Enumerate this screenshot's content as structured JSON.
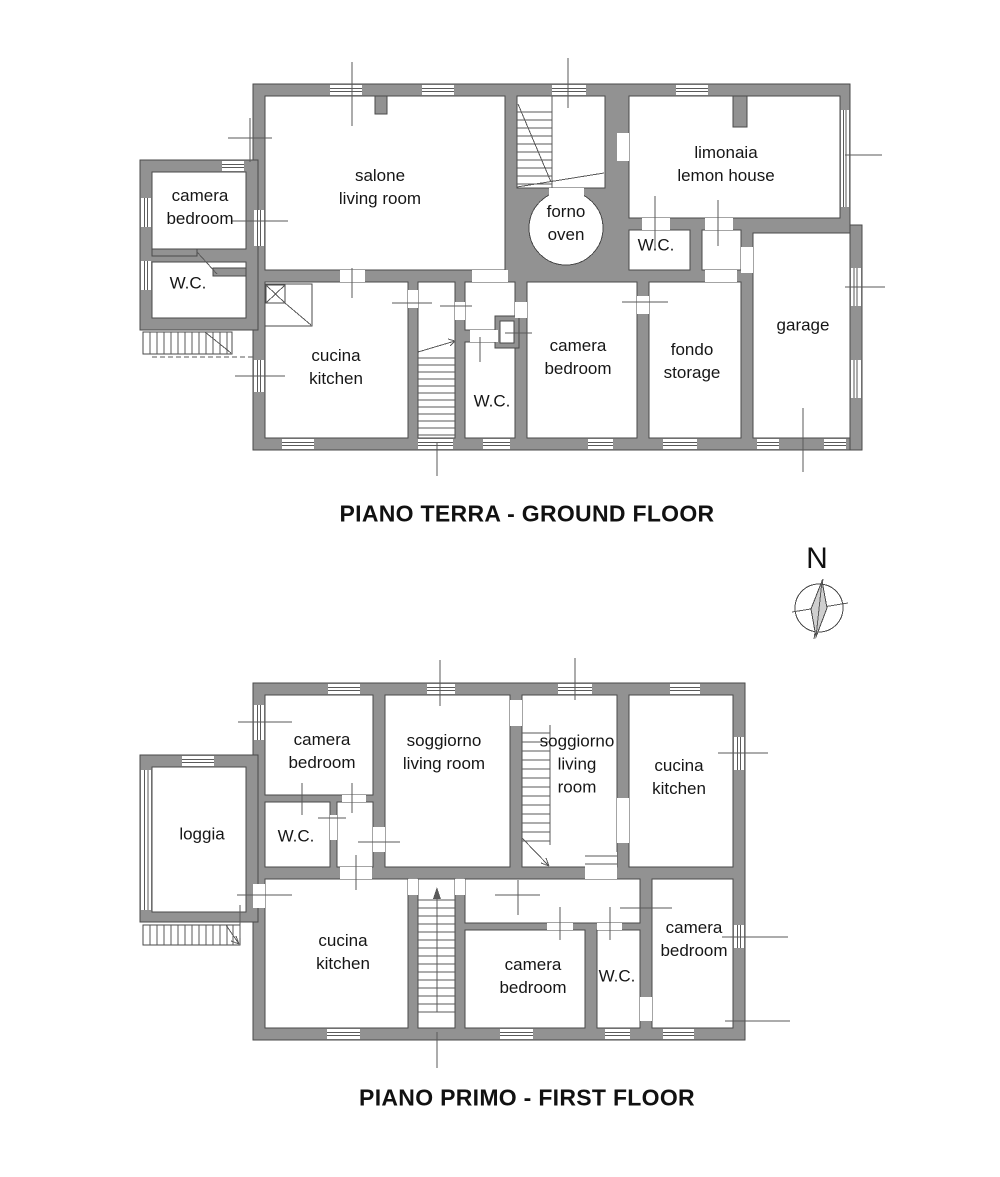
{
  "page": {
    "background": "#ffffff"
  },
  "colors": {
    "wall": "#929292",
    "outline": "#4a4a4a",
    "line": "#5a5a5a",
    "text": "#161616"
  },
  "compass": {
    "north_label": "N"
  },
  "ground_floor": {
    "title": "PIANO TERRA - GROUND FLOOR",
    "rooms": [
      {
        "id": "annex-bedroom",
        "label": "camera\nbedroom"
      },
      {
        "id": "annex-wc",
        "label": "W.C."
      },
      {
        "id": "salone",
        "label": "salone\nliving room"
      },
      {
        "id": "forno",
        "label": "forno\noven"
      },
      {
        "id": "limonaia",
        "label": "limonaia\nlemon house"
      },
      {
        "id": "wc-upper",
        "label": "W.C."
      },
      {
        "id": "garage",
        "label": "garage"
      },
      {
        "id": "cucina",
        "label": "cucina\nkitchen"
      },
      {
        "id": "wc-hall",
        "label": "W.C."
      },
      {
        "id": "camera",
        "label": "camera\nbedroom"
      },
      {
        "id": "fondo",
        "label": "fondo\nstorage"
      }
    ]
  },
  "first_floor": {
    "title": "PIANO PRIMO - FIRST FLOOR",
    "rooms": [
      {
        "id": "camera-nw",
        "label": "camera\nbedroom"
      },
      {
        "id": "soggiorno-left",
        "label": "soggiorno\nliving room"
      },
      {
        "id": "soggiorno-right",
        "label": "soggiorno\nliving\nroom"
      },
      {
        "id": "cucina-ne",
        "label": "cucina\nkitchen"
      },
      {
        "id": "loggia",
        "label": "loggia"
      },
      {
        "id": "wc-upper",
        "label": "W.C."
      },
      {
        "id": "cucina-sw",
        "label": "cucina\nkitchen"
      },
      {
        "id": "camera-s",
        "label": "camera\nbedroom"
      },
      {
        "id": "wc-lower",
        "label": "W.C."
      },
      {
        "id": "camera-se",
        "label": "camera\nbedroom"
      }
    ]
  }
}
